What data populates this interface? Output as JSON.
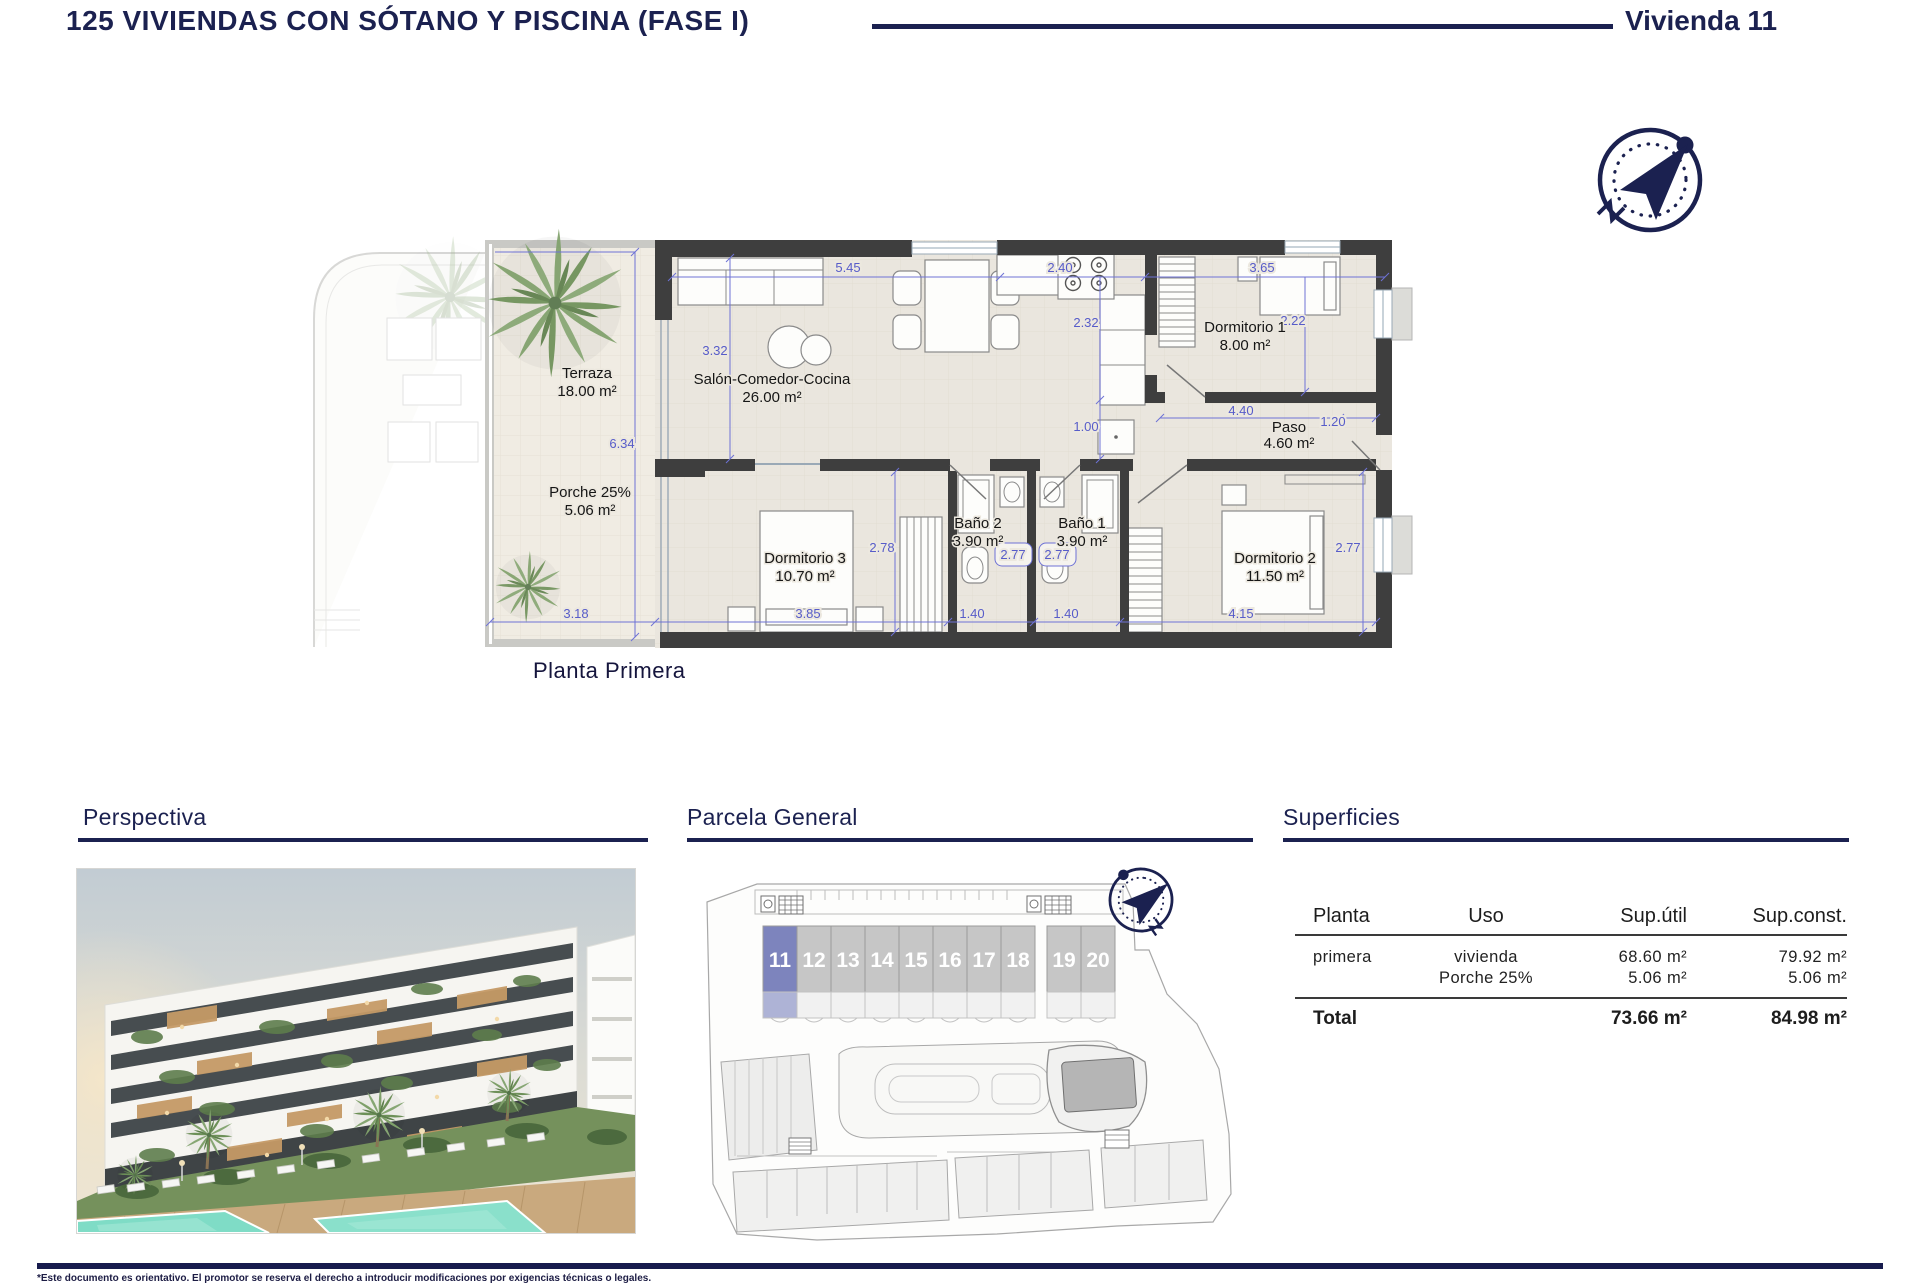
{
  "header": {
    "title": "125 VIVIENDAS CON SÓTANO Y PISCINA (FASE I)",
    "vivienda": "Vivienda 11"
  },
  "floor_plan": {
    "caption": "Planta Primera",
    "rooms": {
      "terraza": {
        "name": "Terraza",
        "area": "18.00 m²"
      },
      "porche": {
        "name": "Porche 25%",
        "area": "5.06 m²"
      },
      "salon": {
        "name": "Salón-Comedor-Cocina",
        "area": "26.00 m²"
      },
      "dormitorio1": {
        "name": "Dormitorio 1",
        "area": "8.00 m²"
      },
      "paso": {
        "name": "Paso",
        "area": "4.60 m²"
      },
      "dormitorio3": {
        "name": "Dormitorio 3",
        "area": "10.70 m²"
      },
      "bano2": {
        "name": "Baño 2",
        "area": "3.90 m²"
      },
      "bano1": {
        "name": "Baño 1",
        "area": "3.90 m²"
      },
      "dormitorio2": {
        "name": "Dormitorio 2",
        "area": "11.50 m²"
      }
    },
    "dims": {
      "top_salon": "5.45",
      "top_kitchen": "2.40",
      "top_dorm1": "3.65",
      "salon_v": "3.32",
      "kitchen_v": "2.32",
      "dorm1_v": "2.22",
      "terraza_v": "6.34",
      "kitchen_gap": "1.00",
      "paso_w": "4.40",
      "paso_r": "1.20",
      "dorm3_v": "2.78",
      "bano2_w": "2.77",
      "bano1_w": "2.77",
      "dorm2_v": "2.77",
      "bottom_terraza": "3.18",
      "bottom_dorm3": "3.85",
      "bottom_bano2": "1.40",
      "bottom_bano1": "1.40",
      "bottom_dorm2": "4.15"
    }
  },
  "sections": {
    "perspectiva": {
      "title": "Perspectiva"
    },
    "parcela": {
      "title": "Parcela General",
      "units": [
        "11",
        "12",
        "13",
        "14",
        "15",
        "16",
        "17",
        "18",
        "19",
        "20"
      ],
      "highlighted_unit": "11"
    },
    "superficies": {
      "title": "Superficies",
      "table": {
        "headers": [
          "Planta",
          "Uso",
          "Sup.útil",
          "Sup.const."
        ],
        "rows": [
          {
            "planta": "primera",
            "uso": "vivienda",
            "util": "68.60 m²",
            "const": "79.92 m²"
          },
          {
            "planta": "",
            "uso": "Porche 25%",
            "util": "5.06 m²",
            "const": "5.06 m²"
          }
        ],
        "total": {
          "label": "Total",
          "util": "73.66 m²",
          "const": "84.98 m²"
        }
      }
    }
  },
  "footer": {
    "disclaimer": "*Este documento es orientativo. El promotor se reserva el derecho a introducir modificaciones por exigencias técnicas o legales."
  },
  "colors": {
    "navy": "#1b2150",
    "dim_blue": "#575cc9",
    "wall": "#3e3e3e",
    "unit_highlight": "#7d84bd",
    "unit_gray": "#c6c6c6",
    "pool": "#7fdcc6"
  }
}
